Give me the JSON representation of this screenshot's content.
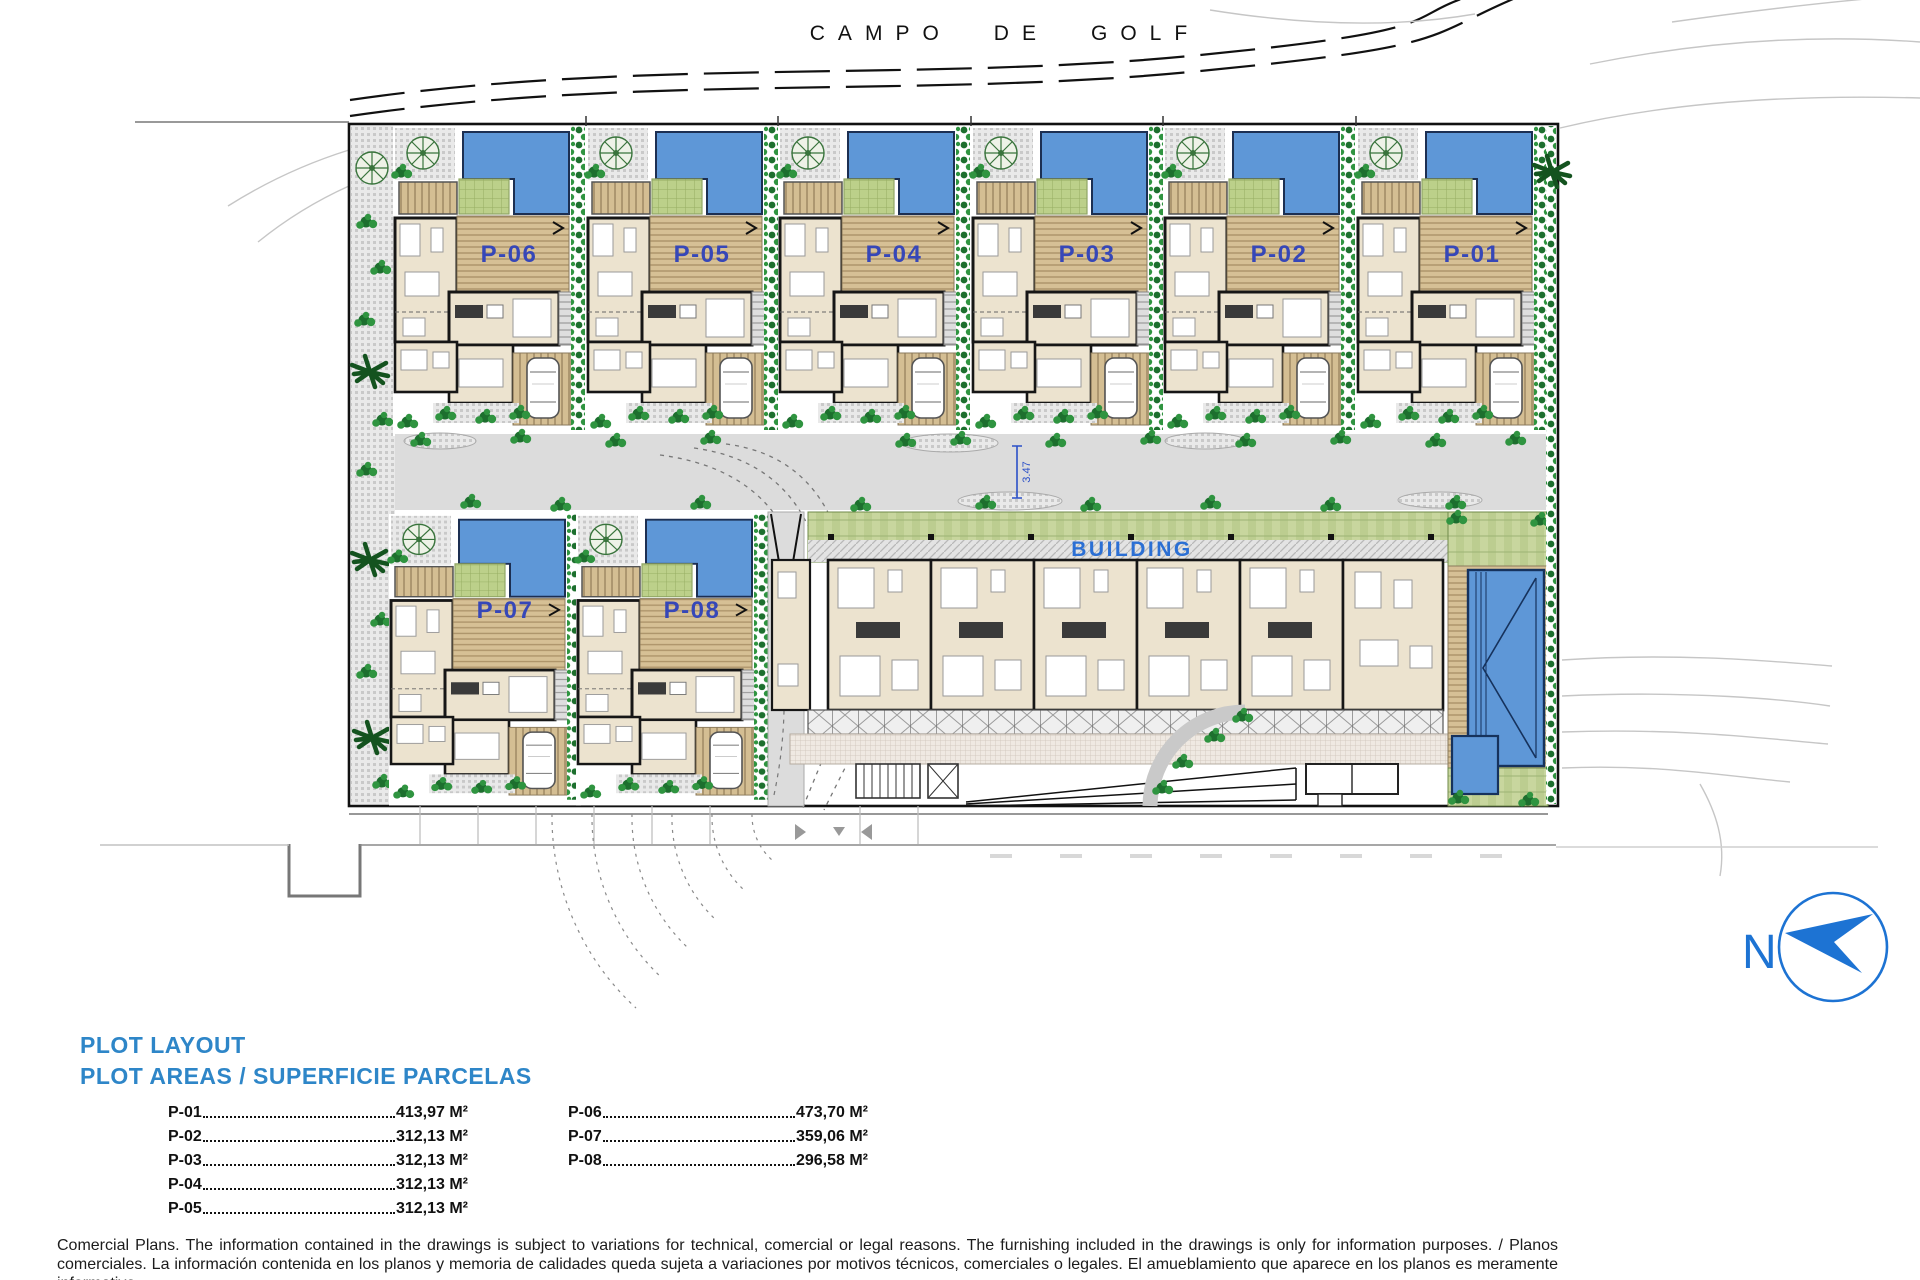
{
  "golf_course_label": "CAMPO DE GOLF",
  "plan": {
    "plots": [
      {
        "label": "P-06"
      },
      {
        "label": "P-05"
      },
      {
        "label": "P-04"
      },
      {
        "label": "P-03"
      },
      {
        "label": "P-02"
      },
      {
        "label": "P-01"
      },
      {
        "label": "P-07"
      },
      {
        "label": "P-08"
      }
    ],
    "building_label": "BUILDING",
    "road_dimension": "3.47"
  },
  "compass": {
    "label": "N"
  },
  "legend": {
    "title_line1": "PLOT LAYOUT",
    "title_line2": "PLOT AREAS / SUPERFICIE PARCELAS",
    "columns": [
      {
        "entries": [
          {
            "plot": "P-01",
            "area": "413,97 M²"
          },
          {
            "plot": "P-02",
            "area": "312,13 M²"
          },
          {
            "plot": "P-03",
            "area": "312,13 M²"
          },
          {
            "plot": "P-04",
            "area": "312,13 M²"
          },
          {
            "plot": "P-05",
            "area": "312,13 M²"
          }
        ]
      },
      {
        "entries": [
          {
            "plot": "P-06",
            "area": "473,70 M²"
          },
          {
            "plot": "P-07",
            "area": "359,06 M²"
          },
          {
            "plot": "P-08",
            "area": "296,58 M²"
          }
        ]
      }
    ]
  },
  "disclaimer": {
    "line1": "Comercial Plans. The information contained in the drawings is subject to variations for technical, comercial or legal reasons. The furnishing included in the drawings is only for information purposes. / Planos",
    "line2": "comerciales. La información contenida en los planos y memoria de calidades queda sujeta a variaciones por motivos técnicos, comerciales o legales. El amueblamiento que aparece en los planos es meramente informativo."
  },
  "colors": {
    "pool": "#5e97d7",
    "plot_label_blue": "#3647b8",
    "building_label_blue": "#2b6fd4",
    "legend_title_blue": "#2e86c8",
    "compass_blue": "#1d73d3",
    "road_gray": "#dcdcdc",
    "house_beige": "#ece3cf",
    "deck_tan": "#d6c095",
    "lawn_green": "#c8d69e",
    "shrub_green": "#2f9440"
  }
}
